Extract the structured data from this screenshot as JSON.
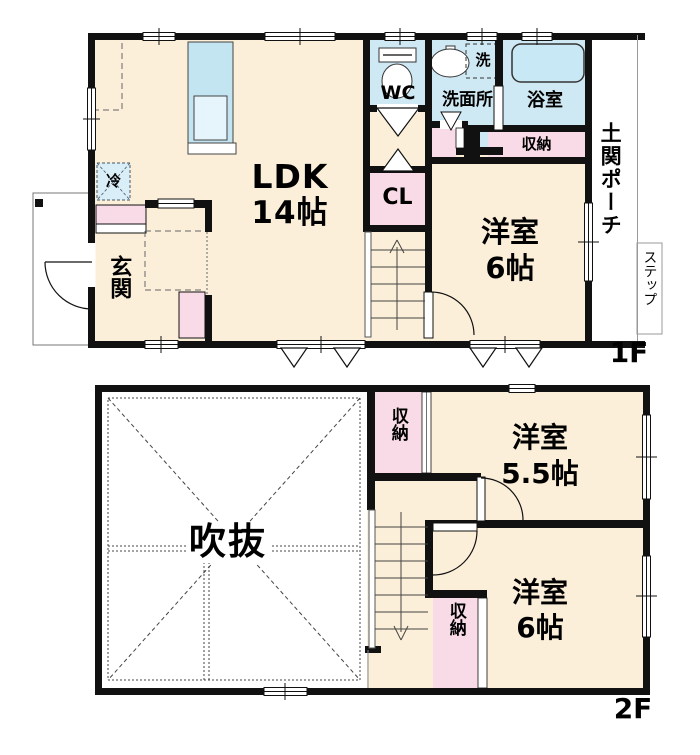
{
  "title": "floor-plan",
  "colors": {
    "wall": "#111111",
    "room_fill": "#fcefd9",
    "water_fill": "#cfe9f4",
    "storage_fill": "#f8dbe6",
    "tub_fill": "#c9e8f5",
    "void_fill": "#ffffff"
  },
  "floor1": {
    "floor_label": "1F",
    "ldk_name": "LDK",
    "ldk_size": "14帖",
    "wc": "WC",
    "washroom": "洗面所",
    "washer": "洗",
    "bath": "浴室",
    "bath_storage": "収納",
    "closet": "CL",
    "fridge": "冷",
    "entrance": "玄関",
    "room6_name": "洋室",
    "room6_size": "6帖",
    "porch": "土関ポーチ",
    "step": "ステップ"
  },
  "floor2": {
    "floor_label": "2F",
    "void": "吹抜",
    "storage_top": "収納",
    "room55_name": "洋室",
    "room55_size": "5.5帖",
    "room6_name": "洋室",
    "room6_size": "6帖",
    "storage_bottom": "収納"
  }
}
